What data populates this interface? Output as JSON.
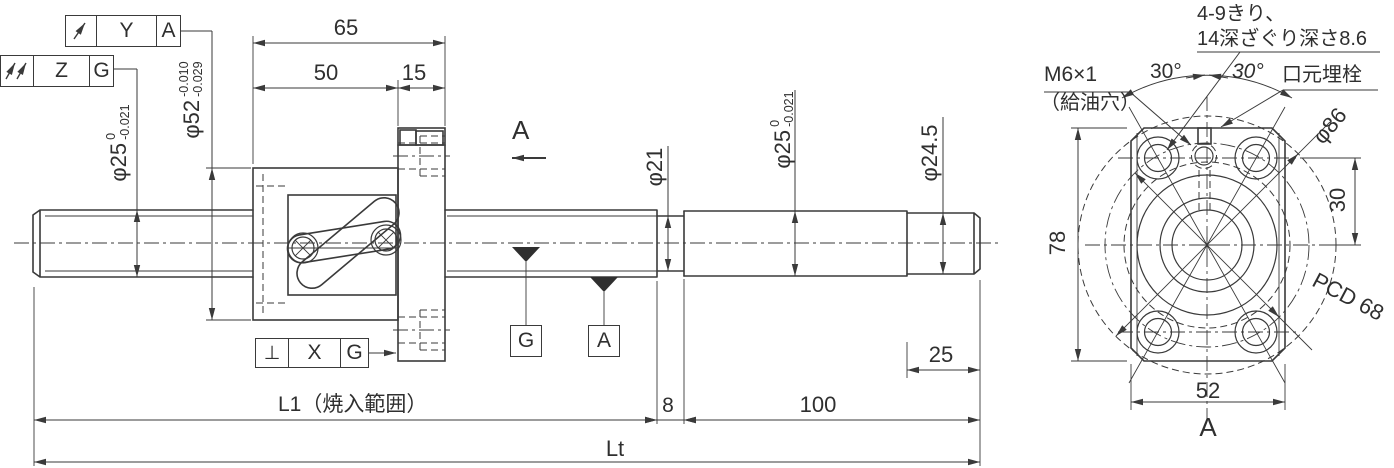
{
  "main_view": {
    "dims": {
      "d65": "65",
      "d50": "50",
      "d15": "15",
      "d8": "8",
      "d100": "100",
      "d25": "25",
      "L1": "L1（焼入範囲）",
      "Lt": "Lt"
    },
    "diameters": {
      "screw": {
        "base": "φ25",
        "tol_upper": "0",
        "tol_lower": "-0.021"
      },
      "nut_od": {
        "base": "φ52",
        "tol_upper": "-0.010",
        "tol_lower": "-0.029"
      },
      "neck": {
        "base": "φ21"
      },
      "journal": {
        "base": "φ25",
        "tol_upper": "0",
        "tol_lower": "-0.021"
      },
      "end": {
        "base": "φ24.5"
      }
    },
    "gdt": {
      "frame_ya": {
        "symbol": "circular-runout",
        "tolerance_zone": "Y",
        "datum": "A"
      },
      "frame_zg": {
        "symbol": "total-runout",
        "tolerance_zone": "Z",
        "datum": "G"
      },
      "frame_xg": {
        "symbol": "perpendicularity",
        "symbol_glyph": "⊥",
        "tolerance_zone": "X",
        "datum": "G"
      }
    },
    "datums": {
      "g": "G",
      "a": "A"
    },
    "section_arrow_label": "A"
  },
  "end_view": {
    "notes": {
      "holes_line1": "4-9きり、",
      "holes_line2": "14深ざぐり深さ8.6",
      "oil_port": "M6×1",
      "oil_port_sub": "（給油穴）",
      "plug": "口元埋栓"
    },
    "angles": {
      "left": "30°",
      "right": "30°"
    },
    "dims": {
      "d78": "78",
      "d30": "30",
      "d52": "52",
      "pcd": "PCD 68",
      "d86": "φ86"
    },
    "view_label": "A"
  },
  "colors": {
    "line": "#3a3a3a",
    "background": "#ffffff"
  }
}
